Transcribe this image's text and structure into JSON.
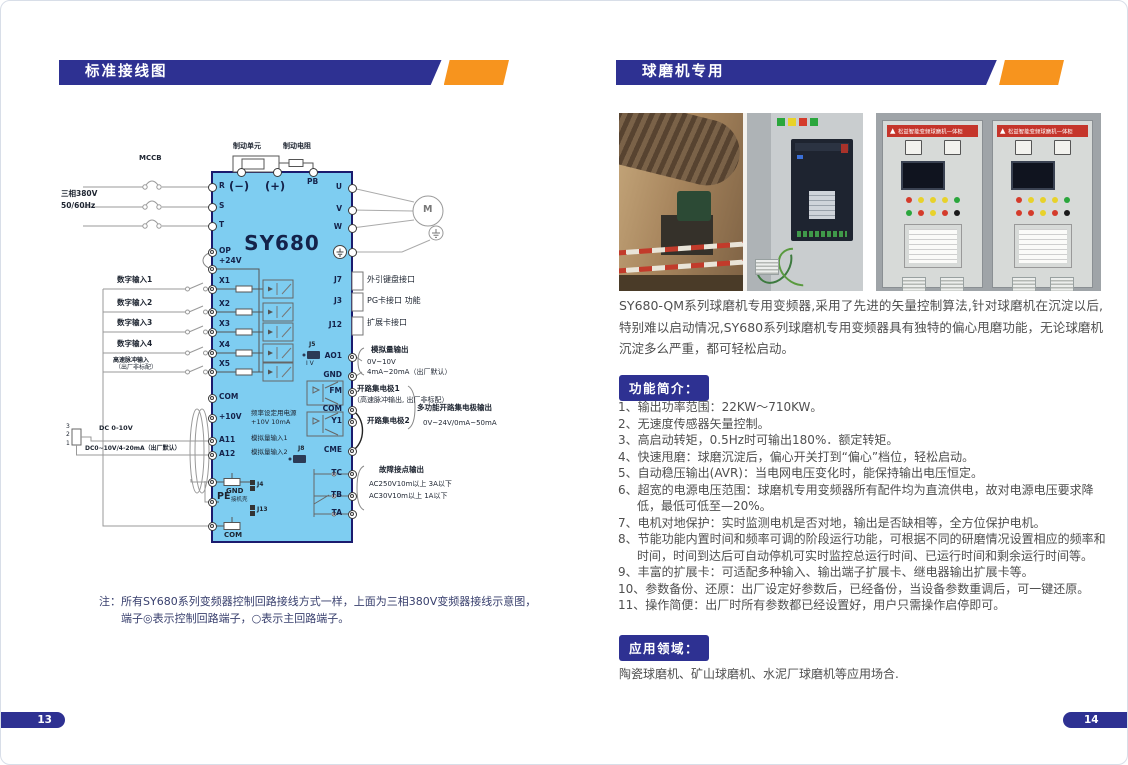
{
  "doc": {
    "colors": {
      "navy": "#2E3192",
      "orange": "#F7941E",
      "diagram_fill": "#7ECDF1"
    },
    "left": {
      "header_title": "标准接线图",
      "page_number": "13",
      "note": {
        "prefix": "注：",
        "line1": "所有SY680系列变频器控制回路接线方式一样，上面为三相380V变频器接线示意图，",
        "line2": "端子◎表示控制回路端子，○表示主回路端子。"
      },
      "diagram": {
        "model": "SY680",
        "brake_unit": "制动单元",
        "brake_resistor": "制动电阻",
        "mccb": "MCCB",
        "supply": [
          "三相380V",
          "50/60Hz"
        ],
        "pot_pins": [
          "3",
          "2",
          "1"
        ],
        "dc_label_1": "DC 0-10V",
        "dc_label_2": "DC0~10V/4-20mA（出厂默认）",
        "pulse_input": {
          "line1": "高速脉冲输入",
          "line2": "（出厂非标配）"
        },
        "motor": "M",
        "top_terminals": [
          {
            "label": "(−)",
            "x": 180,
            "cls": "big"
          },
          {
            "label": "(+)",
            "x": 216,
            "cls": "big"
          },
          {
            "label": "PB",
            "x": 252,
            "cls": "small"
          }
        ],
        "left_terminals": [
          {
            "label": "R",
            "y": 58,
            "type": "main"
          },
          {
            "label": "S",
            "y": 78,
            "type": "main"
          },
          {
            "label": "T",
            "y": 97,
            "type": "main"
          },
          {
            "label": "OP",
            "y": 123,
            "type": "ctrl"
          },
          {
            "label": "+24V",
            "y": 140,
            "type": "ctrl",
            "dy": -12
          },
          {
            "label": "X1",
            "y": 160,
            "type": "ctrl",
            "dy": -12
          },
          {
            "label": "X2",
            "y": 183,
            "type": "ctrl",
            "dy": -12
          },
          {
            "label": "X3",
            "y": 203,
            "type": "ctrl",
            "dy": -12
          },
          {
            "label": "X4",
            "y": 224,
            "type": "ctrl",
            "dy": -12
          },
          {
            "label": "X5",
            "y": 243,
            "type": "ctrl",
            "dy": -12
          },
          {
            "label": "COM",
            "y": 269,
            "type": "ctrl"
          },
          {
            "label": "+10V",
            "y": 289,
            "type": "ctrl"
          },
          {
            "label": "A11",
            "y": 312,
            "type": "ctrl"
          },
          {
            "label": "A12",
            "y": 326,
            "type": "ctrl"
          },
          {
            "label": "",
            "y": 353,
            "type": "ctrl"
          },
          {
            "label": "",
            "y": 373,
            "type": "ctrl"
          },
          {
            "label": "",
            "y": 397,
            "type": "ctrl"
          }
        ],
        "right_terminals": [
          {
            "label": "U",
            "y": 59,
            "type": "main"
          },
          {
            "label": "V",
            "y": 81,
            "type": "main"
          },
          {
            "label": "W",
            "y": 99,
            "type": "main"
          },
          {
            "label": "",
            "y": 123,
            "type": "main"
          },
          {
            "label": "J7",
            "y": 152,
            "type": "conn"
          },
          {
            "label": "J3",
            "y": 173,
            "type": "conn"
          },
          {
            "label": "J12",
            "y": 197,
            "type": "conn"
          },
          {
            "label": "AO1",
            "y": 228,
            "type": "ctrl"
          },
          {
            "label": "GND",
            "y": 247,
            "type": "ctrl"
          },
          {
            "label": "FM",
            "y": 263,
            "type": "ctrl"
          },
          {
            "label": "COM",
            "y": 281,
            "type": "ctrl"
          },
          {
            "label": "Y1",
            "y": 293,
            "type": "ctrl"
          },
          {
            "label": "CME",
            "y": 322,
            "type": "ctrl"
          },
          {
            "label": "TC",
            "y": 345,
            "type": "ctrl"
          },
          {
            "label": "TB",
            "y": 367,
            "type": "ctrl"
          },
          {
            "label": "TA",
            "y": 385,
            "type": "ctrl"
          }
        ],
        "digital_inputs": [
          {
            "label": "数字输入1",
            "y": 160
          },
          {
            "label": "数字输入2",
            "y": 183
          },
          {
            "label": "数字输入3",
            "y": 203
          },
          {
            "label": "数字输入4",
            "y": 224
          }
        ],
        "internal": {
          "freq1": "频率设定用电源",
          "freq2": "+10V 10mA",
          "ai1": "模拟量输入1",
          "ai2": "模拟量输入2",
          "gnd": "GND",
          "j4": "J4",
          "pe": "PE",
          "pe_suffix": "接机壳",
          "j13": "J13",
          "com": "COM",
          "j5": "J5",
          "j8": "J8",
          "iv": "I V"
        },
        "ann": {
          "keypad": "外引键盘接口",
          "pg": "PG卡接口 功能",
          "expand": "扩展卡接口",
          "ao_title": "模拟量输出",
          "ao_r1": "0V~10V",
          "ao_r2": "4mA~20mA（出厂默认）",
          "oc1": "开路集电极1",
          "oc1_note": "（高速脉冲输出, 出厂非标配）",
          "oc2": "开路集电极2",
          "oc_multi1": "多功能开路集电极输出",
          "oc_multi2": "0V~24V/0mA~50mA",
          "fault_title": "故障接点输出",
          "fault1": "AC250V10m以上 3A以下",
          "fault2": "AC30V10m以上 1A以下"
        }
      }
    },
    "right": {
      "header_title": "球磨机专用",
      "page_number": "14",
      "photos": {
        "banner_text": "松益智能变频球磨机一体柜"
      },
      "intro": "SY680-QM系列球磨机专用变频器,采用了先进的矢量控制算法,针对球磨机在沉淀以后,特别难以启动情况,SY680系列球磨机专用变频器具有独特的偏心甩磨功能，无论球磨机沉淀多么严重，都可轻松启动。",
      "features_title": "功能简介：",
      "features": [
        "1、输出功率范围：22KW～710KW。",
        "2、无速度传感器矢量控制。",
        "3、高启动转矩，0.5Hz时可输出180%．额定转矩。",
        "4、快速甩磨：球磨沉淀后，偏心开关打到“偏心”档位，轻松启动。",
        "5、自动稳压输出(AVR)：当电网电压变化时，能保持输出电压恒定。",
        "6、超宽的电源电压范围：球磨机专用变频器所有配件均为直流供电，故对电源电压要求降低，最低可低至—20%。",
        "7、电机对地保护：实时监测电机是否对地，输出是否缺相等，全方位保护电机。",
        "8、节能功能内置时间和频率可调的阶段运行功能，可根据不同的研磨情况设置相应的频率和时间，时间到达后可自动停机可实时监控总运行时间、已运行时间和剩余运行时间等。",
        "9、丰富的扩展卡：可适配多种输入、输出端子扩展卡、继电器输出扩展卡等。",
        "10、参数备份、还原：出厂设定好参数后，已经备份，当设备参数重调后，可一键还原。",
        "11、操作简便：出厂时所有参数都已经设置好，用户只需操作启停即可。"
      ],
      "application_title": "应用领域：",
      "application_text": "陶瓷球磨机、矿山球磨机、水泥厂球磨机等应用场合."
    }
  }
}
